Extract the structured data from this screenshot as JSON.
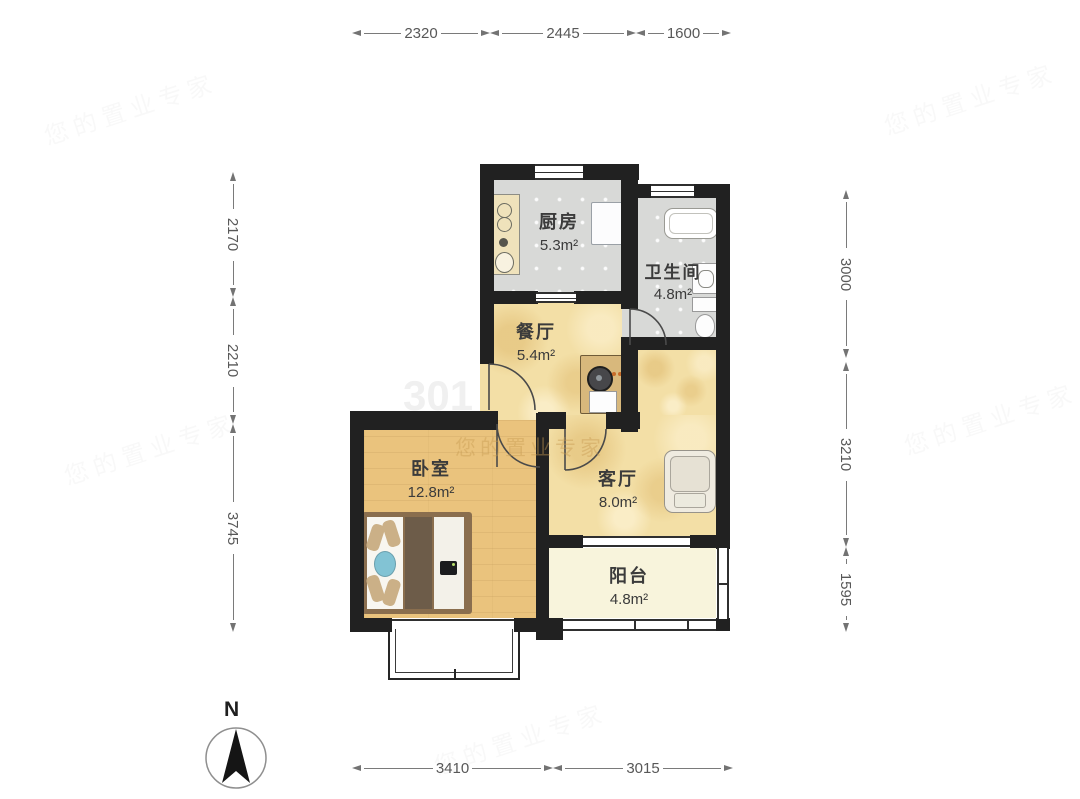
{
  "compass": {
    "label": "N"
  },
  "rooms": {
    "kitchen": {
      "name": "厨房",
      "area": "5.3m²"
    },
    "bathroom": {
      "name": "卫生间",
      "area": "4.8m²"
    },
    "dining": {
      "name": "餐厅",
      "area": "5.4m²"
    },
    "bedroom": {
      "name": "卧室",
      "area": "12.8m²"
    },
    "living": {
      "name": "客厅",
      "area": "8.0m²"
    },
    "balcony": {
      "name": "阳台",
      "area": "4.8m²"
    }
  },
  "dimensions": {
    "top": [
      "2320",
      "2445",
      "1600"
    ],
    "left": [
      "2170",
      "2210",
      "3745"
    ],
    "right": [
      "3000",
      "3210",
      "1595"
    ],
    "bottom": [
      "3410",
      "3015"
    ]
  },
  "watermark": {
    "primary": "您的置业专家",
    "fragment": "301"
  },
  "colors": {
    "wall": "#212121",
    "tile_floor": "#d8d9d7",
    "wood_floor": "#f3dfa6",
    "bedroom_floor": "#eac37d",
    "balcony_floor": "#f8f4dc",
    "bed_accent": "#82c3d4",
    "dimension_text": "#585858"
  }
}
